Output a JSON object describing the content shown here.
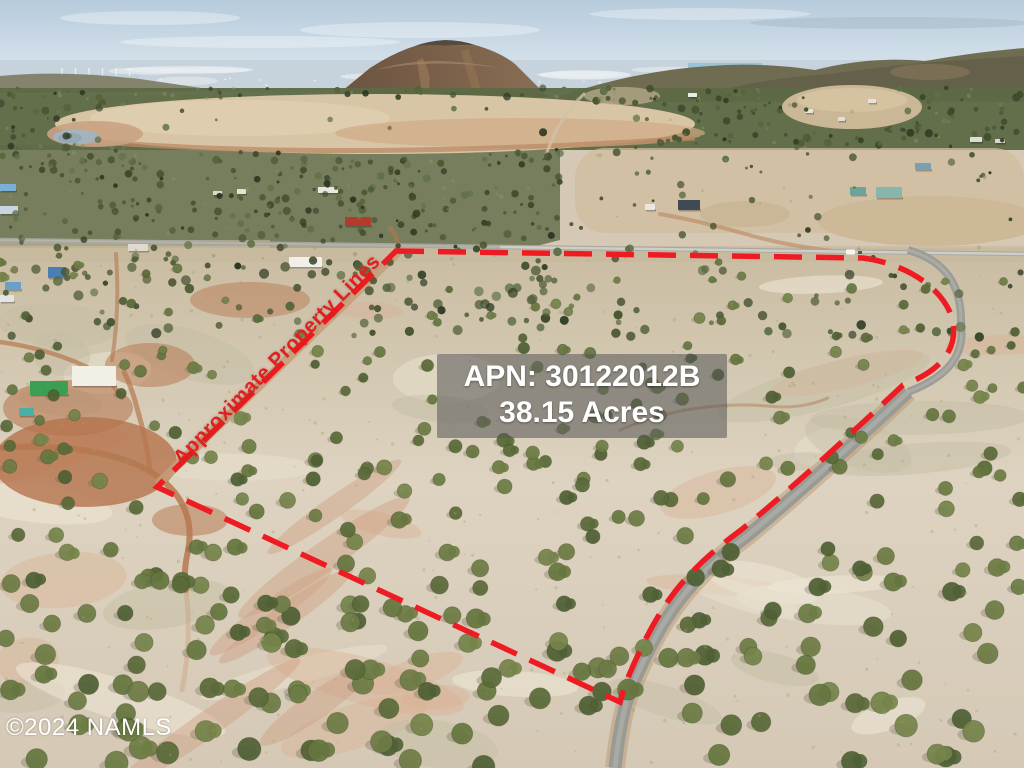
{
  "overlay": {
    "apn_label": "APN: 30122012B",
    "acreage_label": "38.15 Acres",
    "boundary_label": "Approximate Property Lines",
    "watermark": "©2024 NAMLS"
  },
  "colors": {
    "boundary_red": "#ee1c22",
    "label_red": "#e1201f",
    "overlay_text": "#ffffff",
    "overlay_box_bg": "rgba(86,86,86,0.55)"
  },
  "boundary": {
    "path": "M396,251 L863,258 C902,263 944,286 953,321 C958,352 938,372 903,385 C855,430 795,486 741,530 C707,555 680,580 659,615 C645,638 633,665 625,685 L620,702 L157,487 Z",
    "dash_pattern": "28 14",
    "stroke_width": 5.5
  },
  "scene": {
    "seed": 1337,
    "palette": {
      "sky_top": "#b6cbdc",
      "sky_bottom": "#e2ebf1",
      "haze": "#c7d3dc",
      "cone_left": "#6b533f",
      "cone_right": "#8a6e55",
      "cone_top": "#564a3e",
      "ridge": "#6f6c52",
      "ridge_dark": "#625e48",
      "forest_base": "#5d6945",
      "forest": [
        "#3e4a2e",
        "#49562f",
        "#56633c",
        "#2f3a23",
        "#60704a"
      ],
      "forest_light": [
        "#7d895c",
        "#8e9a6a"
      ],
      "bush": [
        "#66763f",
        "#5a6a39",
        "#75844a",
        "#4f6034",
        "#6d7c45"
      ],
      "ground_top": "#c9bca2",
      "ground_mid": "#ddd3c0",
      "ground_bottom": "#d5c9b6",
      "clearing": "#d8c5a5",
      "pink_soil": "#d1aa88",
      "rust": "#b5734c",
      "dirt_road": "#b5784f",
      "paved_road": "#9d9d97",
      "pond": "#a3b4bc"
    },
    "houses": [
      [
        318,
        187,
        20,
        6,
        "#e9e7e0"
      ],
      [
        237,
        189,
        9,
        5,
        "#e3e0d8"
      ],
      [
        213,
        191,
        9,
        4,
        "#dcd9d0"
      ],
      [
        345,
        217,
        26,
        9,
        "#b23b2c"
      ],
      [
        289,
        257,
        33,
        10,
        "#f1efe9"
      ],
      [
        128,
        244,
        20,
        7,
        "#dfdacd"
      ],
      [
        0,
        184,
        16,
        7,
        "#7ab0d8"
      ],
      [
        0,
        206,
        18,
        8,
        "#c9d6e2"
      ],
      [
        48,
        267,
        18,
        11,
        "#4a7fb5"
      ],
      [
        5,
        282,
        16,
        8,
        "#6aa0c8"
      ],
      [
        0,
        295,
        14,
        7,
        "#e2e4e6"
      ],
      [
        30,
        381,
        38,
        14,
        "#3b9e53"
      ],
      [
        72,
        366,
        44,
        20,
        "#f2efe5"
      ],
      [
        19,
        408,
        15,
        8,
        "#49b0a8"
      ],
      [
        645,
        204,
        10,
        6,
        "#e8e6de"
      ],
      [
        678,
        200,
        22,
        10,
        "#3e4a55"
      ],
      [
        850,
        187,
        16,
        8,
        "#6ca39b"
      ],
      [
        876,
        187,
        26,
        11,
        "#88b5ac"
      ],
      [
        915,
        163,
        16,
        7,
        "#7a9fb5"
      ],
      [
        970,
        137,
        12,
        5,
        "#dfddd5"
      ],
      [
        995,
        139,
        10,
        4,
        "#d8d5cc"
      ],
      [
        688,
        93,
        9,
        4,
        "#eceae4"
      ],
      [
        805,
        109,
        8,
        4,
        "#e8e5de"
      ],
      [
        838,
        117,
        7,
        4,
        "#e2dfd8"
      ],
      [
        868,
        99,
        8,
        4,
        "#e5e2db"
      ]
    ],
    "counts": {
      "forest": 1500,
      "forest_light": 320,
      "bushes": 520,
      "tufts": 260,
      "patches": 42
    }
  }
}
